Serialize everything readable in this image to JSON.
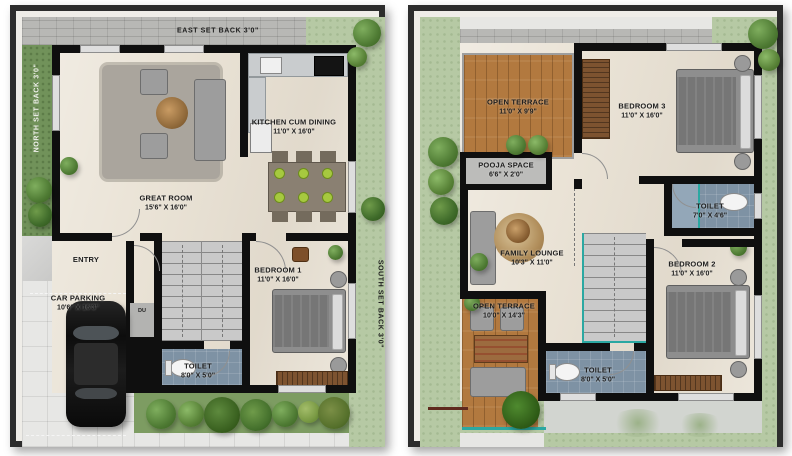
{
  "ground_floor": {
    "setback_top": "EAST SET BACK 3'0\"",
    "setback_left": "NORTH SET BACK 3'0\"",
    "setback_right": "SOUTH SET BACK 3'0\"",
    "rooms": {
      "great_room": {
        "name": "GREAT ROOM",
        "dims": "15'6\" X 16'0\""
      },
      "kitchen": {
        "name": "KITCHEN CUM DINING",
        "dims": "11'0\" X 16'0\""
      },
      "entry": {
        "name": "ENTRY",
        "dims": ""
      },
      "car_parking": {
        "name": "CAR PARKING",
        "dims": "10'6\" X 16'3\""
      },
      "bedroom1": {
        "name": "BEDROOM 1",
        "dims": "11'0\" X 16'0\""
      },
      "toilet": {
        "name": "TOILET",
        "dims": "8'0\" X 5'0\""
      },
      "duct": {
        "name": "DU",
        "dims": ""
      }
    }
  },
  "first_floor": {
    "rooms": {
      "open_terrace_top": {
        "name": "OPEN TERRACE",
        "dims": "11'0\" X 9'9\""
      },
      "bedroom3": {
        "name": "BEDROOM 3",
        "dims": "11'0\" X 16'0\""
      },
      "pooja": {
        "name": "POOJA SPACE",
        "dims": "6'6\" X 2'0\""
      },
      "family_lounge": {
        "name": "FAMILY LOUNGE",
        "dims": "10'3\" X 11'0\""
      },
      "toilet_upper": {
        "name": "TOILET",
        "dims": "7'0\" X 4'6\""
      },
      "bedroom2": {
        "name": "BEDROOM 2",
        "dims": "11'0\" X 16'0\""
      },
      "open_terrace_bottom": {
        "name": "OPEN TERRACE",
        "dims": "10'0\" X 14'3\""
      },
      "toilet_lower": {
        "name": "TOILET",
        "dims": "8'0\" X 5'0\""
      }
    }
  },
  "colors": {
    "wall": "#0f0f0f",
    "floor_beige": "#eae3d6",
    "toilet_floor": "#7e92a4",
    "terrace_wood": "#b2793f",
    "grass_dark": "#71925a",
    "grass_light": "#b6c9a4",
    "stairs": "#c9c9c9",
    "railing_teal": "#2ba8a2",
    "plan_border": "#2d2d2d"
  }
}
